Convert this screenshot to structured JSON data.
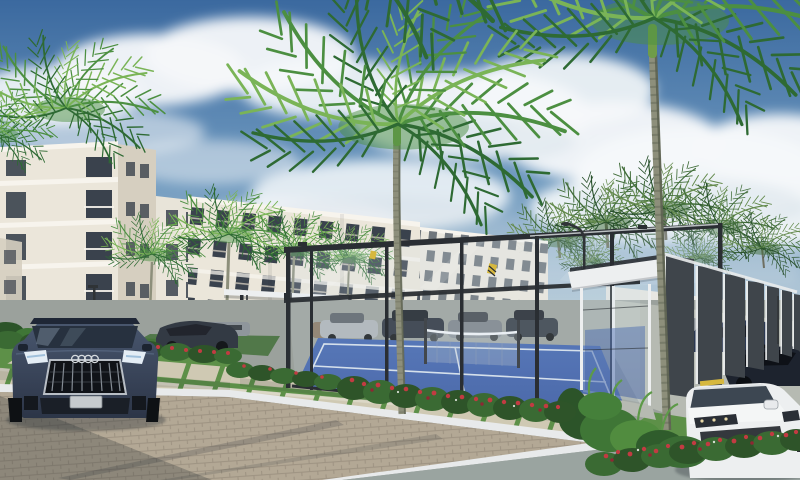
{
  "meta": {
    "title": "Residential complex exterior 3D rendering",
    "image_type": "architectural-render",
    "width_px": 800,
    "height_px": 480,
    "description": "3D architectural rendering of a tropical apartment complex: white mid-rise apartment buildings, tall royal palm trees, a glass-walled blue padel court, a dark slatted pavilion, an entrance canopy with bench, parked cars including a dark Audi SUV and a white SUV, red flowering hedges, paver road and walkway under a partly cloudy blue sky."
  },
  "palette": {
    "sky_top": "#3b699f",
    "sky_mid": "#6d98be",
    "sky_horizon": "#b8ccd9",
    "cloud": "#f5f8fa",
    "cloud_shade": "#c9d6e2",
    "building_wall": "#ebe6da",
    "building_wall_shade": "#d6cfc0",
    "building_band": "#f7f4ed",
    "window_glass": "#3a424d",
    "wall_white": "#e7e6e1",
    "palm_dark": "#2e6a33",
    "palm_mid": "#4c8f41",
    "palm_light": "#7ab457",
    "trunk": "#8d8f7b",
    "trunk_dark": "#575d4c",
    "court_blue": "#35549e",
    "court_blue_light": "#4266b0",
    "court_line": "#e2e9f2",
    "frame_dark": "#2a2e33",
    "glass_tint": "#d3e2ea",
    "pavilion_fin": "#3f454b",
    "pavilion_white": "#edeff0",
    "grass": "#5d9048",
    "grass_dark": "#3f6e35",
    "hedge": "#3a6a33",
    "hedge_light": "#548a3f",
    "flower_red": "#c23b42",
    "paver_beige": "#b3a895",
    "paver_light": "#cfc9b3",
    "asphalt": "#9aa4a0",
    "concrete": "#b6bab2",
    "curb_white": "#e8eaeb",
    "shadow": "#232a30",
    "car_dark": "#2c3547",
    "car_dark_hi": "#4a5870",
    "car_gray": "#7b8289",
    "car_white": "#edeff0",
    "wheel_stop_yellow": "#d6b83e",
    "headlight": "#e4edf5",
    "lamp_dark": "#2f3336"
  },
  "scene": {
    "setting": "tropical residential complex, daytime, partly cloudy",
    "buildings": [
      {
        "name": "apartment-block-left",
        "floors": 5,
        "style": "white facade, horizontal bands, balconies"
      },
      {
        "name": "apartment-block-center",
        "floors": 4,
        "style": "white facade, balcony grid"
      },
      {
        "name": "apartment-block-far",
        "floors": 4,
        "style": "seen through padel court glass"
      }
    ],
    "amenities": [
      {
        "name": "padel-court",
        "surface": "blue with white lines",
        "enclosure": "glass walls with dark steel frame, center net"
      },
      {
        "name": "pavilion",
        "style": "white roof, dark vertical fins"
      },
      {
        "name": "entrance-canopy",
        "style": "white slab on dark posts"
      },
      {
        "name": "bench",
        "material": "concrete"
      }
    ],
    "vehicles": [
      {
        "name": "dark-audi-suv",
        "color": "dark blue-gray",
        "detail": "four-rings badge, vertical slat grille, lit headlights, blank license plate"
      },
      {
        "name": "dark-sedan",
        "color": "dark gray"
      },
      {
        "name": "parked-cars-behind-court",
        "count": 4
      },
      {
        "name": "parked-cars-right",
        "count": 2
      },
      {
        "name": "white-suv",
        "color": "white"
      }
    ],
    "vegetation": {
      "royal_palms_large": 3,
      "palms_medium": 4,
      "palms_distant": 7,
      "hedges_with_red_flowers": 3,
      "shrub_clusters": 2
    },
    "infrastructure": [
      "brick-paver-road",
      "asphalt-road",
      "white-curbs",
      "grid-paver-walkway",
      "street-lamps",
      "boundary-wall",
      "yellow-wheel-stops",
      "yellow-black-curb"
    ]
  }
}
